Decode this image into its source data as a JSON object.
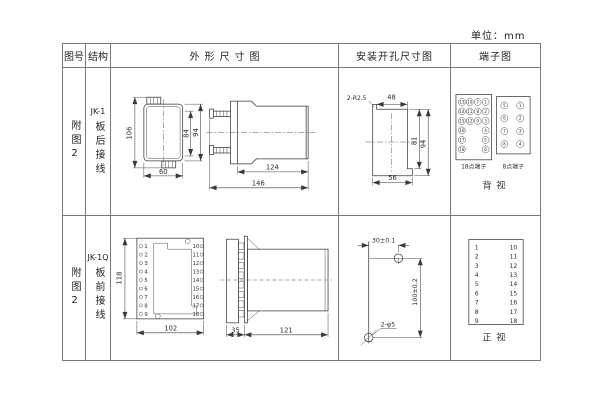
{
  "unit_label": "单位：mm",
  "colors": {
    "ink": "#3a3a3a",
    "table_border": "#7a7a7a",
    "background": "#ffffff"
  },
  "header": {
    "fig": "图号",
    "structure": "结构",
    "outline": "外形尺寸图",
    "mounting": "安装开孔尺寸图",
    "terminal": "端子图"
  },
  "rows": [
    {
      "fig_no": "附图2",
      "model": "JK-1",
      "wiring": "板后接线",
      "outline": {
        "front": {
          "height_overall": "106",
          "height_inner": "84",
          "height_body": "94",
          "width": "60"
        },
        "side": {
          "depth_body": "124",
          "depth_overall": "146"
        }
      },
      "mounting": {
        "corner_radius": "2-R2.5",
        "width_top": "48",
        "width_bottom": "56",
        "height_inner": "81",
        "height_overall": "94"
      },
      "terminal": {
        "panel18": {
          "label": "18点端子",
          "grid": [
            [
              13,
              10,
              7,
              1
            ],
            [
              14,
              11,
              8,
              2
            ],
            [
              15,
              12,
              9,
              3
            ],
            [
              16,
              null,
              null,
              4
            ],
            [
              17,
              null,
              null,
              5
            ],
            [
              18,
              null,
              null,
              6
            ]
          ]
        },
        "panel8": {
          "label": "8点端子",
          "grid": [
            [
              5,
              1
            ],
            [
              6,
              2
            ],
            [
              7,
              3
            ],
            [
              8,
              4
            ]
          ]
        },
        "view_label": "背视"
      }
    },
    {
      "fig_no": "附图2",
      "model": "JK-1Q",
      "wiring": "板前接线",
      "outline": {
        "front": {
          "height": "118",
          "width": "102",
          "left_terminals": [
            1,
            2,
            3,
            4,
            5,
            6,
            7,
            8,
            9
          ],
          "right_terminals": [
            10,
            11,
            12,
            13,
            14,
            15,
            16,
            17,
            18
          ]
        },
        "side": {
          "depth_front": "35",
          "depth_body": "121"
        }
      },
      "mounting": {
        "hole_spacing_x": "30±0.1",
        "hole_spacing_y": "100±0.2",
        "holes": "2-φ5"
      },
      "terminal": {
        "left_col": [
          1,
          2,
          3,
          4,
          5,
          6,
          7,
          8,
          9
        ],
        "right_col": [
          10,
          11,
          12,
          13,
          14,
          15,
          16,
          17,
          18
        ],
        "view_label": "正视"
      }
    }
  ]
}
